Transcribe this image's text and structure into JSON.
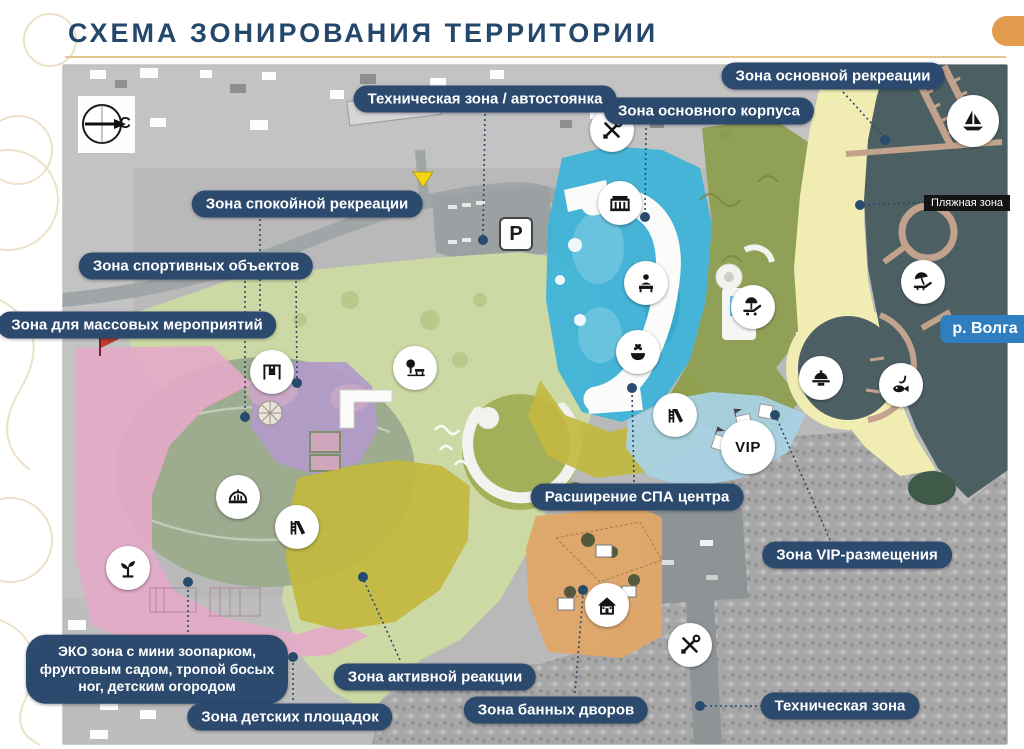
{
  "header": {
    "title": "СХЕМА ЗОНИРОВАНИЯ ТЕРРИТОРИИ"
  },
  "map": {
    "compass": "С",
    "parking": "P",
    "vip": "VIP",
    "river_label": "р. Волга",
    "beach_label": "Пляжная зона",
    "labels": {
      "tech_parking": "Техническая зона / автостоянка",
      "main_building": "Зона основного корпуса",
      "main_recreation": "Зона основной рекреации",
      "quiet_recreation": "Зона спокойной рекреации",
      "sports": "Зона спортивных объектов",
      "mass_events": "Зона для массовых мероприятий",
      "spa_expansion": "Расширение СПА центра",
      "vip_zone": "Зона VIP-размещения",
      "eco": "ЭКО зона с мини зоопарком, фруктовым садом, тропой босых ног, детским огородом",
      "active": "Зона активной реакции",
      "children": "Зона детских площадок",
      "banya": "Зона банных дворов",
      "tech": "Техническая зона"
    },
    "palette": {
      "label_bg": "#2c4a6e",
      "title": "#24486b",
      "underline": "#e7c58e",
      "corner_tab": "#e39b4d",
      "water": "#4c6064",
      "beach": "#f1edb2",
      "main_building_zone": "#3fb3d8",
      "quiet_recreation": "#cdd9a5",
      "sports_zone": "#b29aca",
      "mass_events_zone": "#e3aac7",
      "active_zone": "#c2b83e",
      "vip_zone": "#a8d2e3",
      "banya_zone": "#dfa768",
      "forest_olive": "#8d9d4e",
      "river_label_bg": "#2e7ec0",
      "pier": "#c2a28c"
    },
    "icons": [
      "tools-icon",
      "parking-icon",
      "building-icon",
      "reception-icon",
      "spa-icon",
      "pool-lounge-icon",
      "room-service-icon",
      "fishing-icon",
      "beach-icon",
      "sailboat-icon",
      "swing-icon",
      "tree-bench-icon",
      "arena-icon",
      "slide-icon",
      "sprout-icon",
      "house-icon",
      "vip-badge",
      "compass-icon",
      "north-arrow"
    ]
  }
}
